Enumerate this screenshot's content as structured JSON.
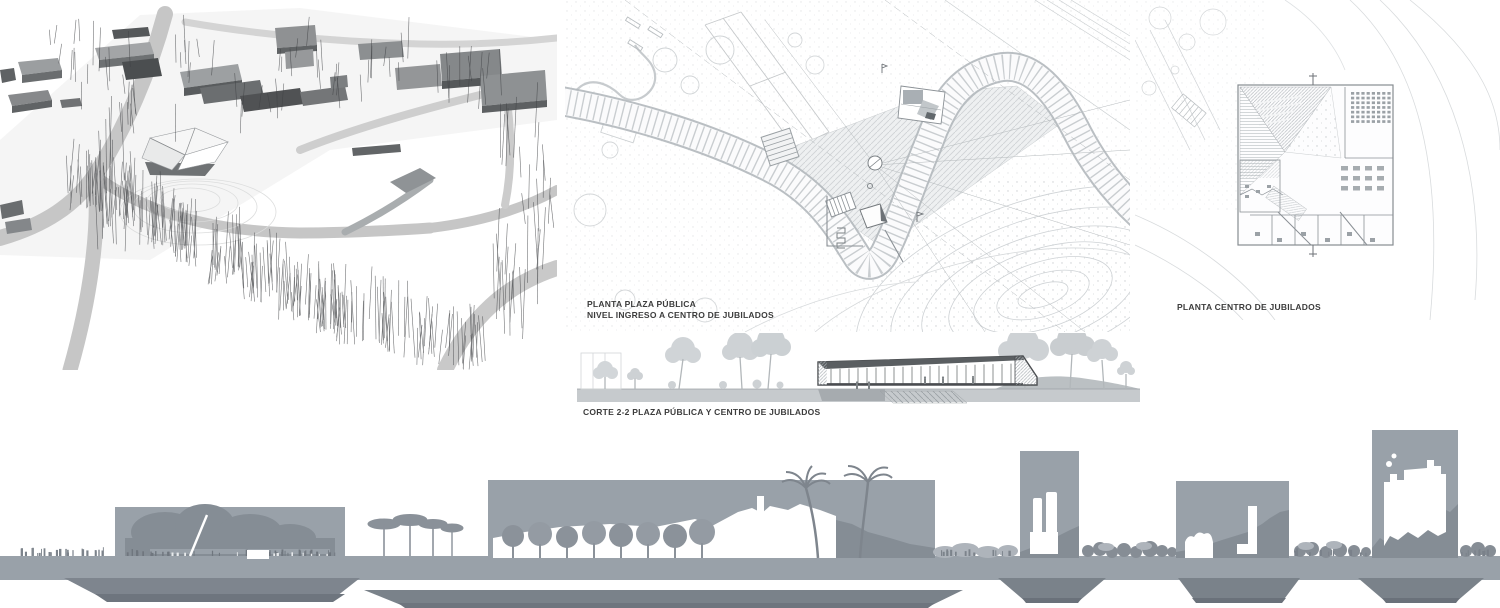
{
  "labels": {
    "plan_plaza_line1": "PLANTA PLAZA PÚBLICA",
    "plan_plaza_line2": "NIVEL INGRESO A CENTRO DE JUBILADOS",
    "plan_centro": "PLANTA CENTRO DE JUBILADOS",
    "section": "CORTE 2-2 PLAZA PÚBLICA Y CENTRO DE JUBILADOS"
  },
  "colors": {
    "background": "#ffffff",
    "silhouette_gray": "#99a1a9",
    "silhouette_shadow": "#858d95",
    "silhouette_light_tuft": "#aeb4bb",
    "underground_gray": "#7a828a",
    "underground_dark": "#6e757e",
    "render_building_gray": "#8a8d8f",
    "render_building_dark": "#55585a",
    "render_road_gray": "#c6c6c6",
    "render_tree_line": "#3f4144",
    "plan_line_gray": "#a8adb1",
    "plan_light_line": "#cdd1d3",
    "section_tree_gray": "#d0d4d7",
    "section_building_dark": "#4a4d50",
    "section_ground_gray": "#c6cacd",
    "text": "#3c3c3c"
  }
}
